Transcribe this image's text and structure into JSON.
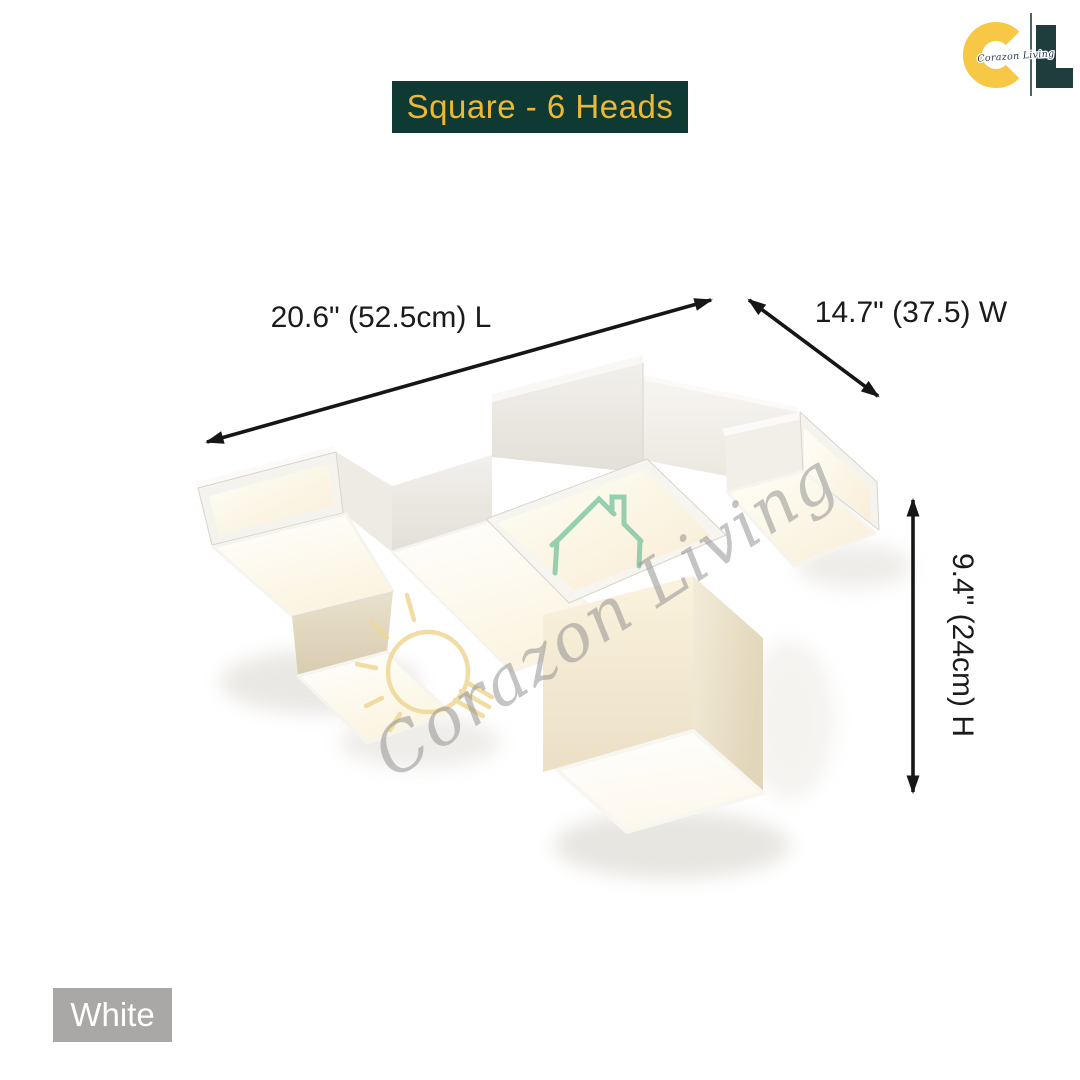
{
  "badge": {
    "label": "Square - 6 Heads"
  },
  "logo": {
    "letter_c": "C",
    "letter_l": "L",
    "script": "Corazon Living"
  },
  "dimensions": {
    "length_label": "20.6\" (52.5cm) L",
    "width_label": "14.7\" (37.5) W",
    "height_label": "9.4\" (24cm) H"
  },
  "variant": {
    "label": "White"
  },
  "watermark": {
    "script": "Corazon Living"
  },
  "colors": {
    "badge_bg": "#0e3a33",
    "badge_text": "#eeb832",
    "logo_c": "#f6c845",
    "logo_l": "#1e3d3c",
    "logo_script": "#2b3b55",
    "chip_bg": "#a9a8a7",
    "chip_text": "#ffffff",
    "arrow": "#161616",
    "label_text": "#1b1b1b",
    "watermark_gray": "#8f8f8f",
    "watermark_teal": "#8ccbaa",
    "watermark_yellow": "#efd795"
  }
}
